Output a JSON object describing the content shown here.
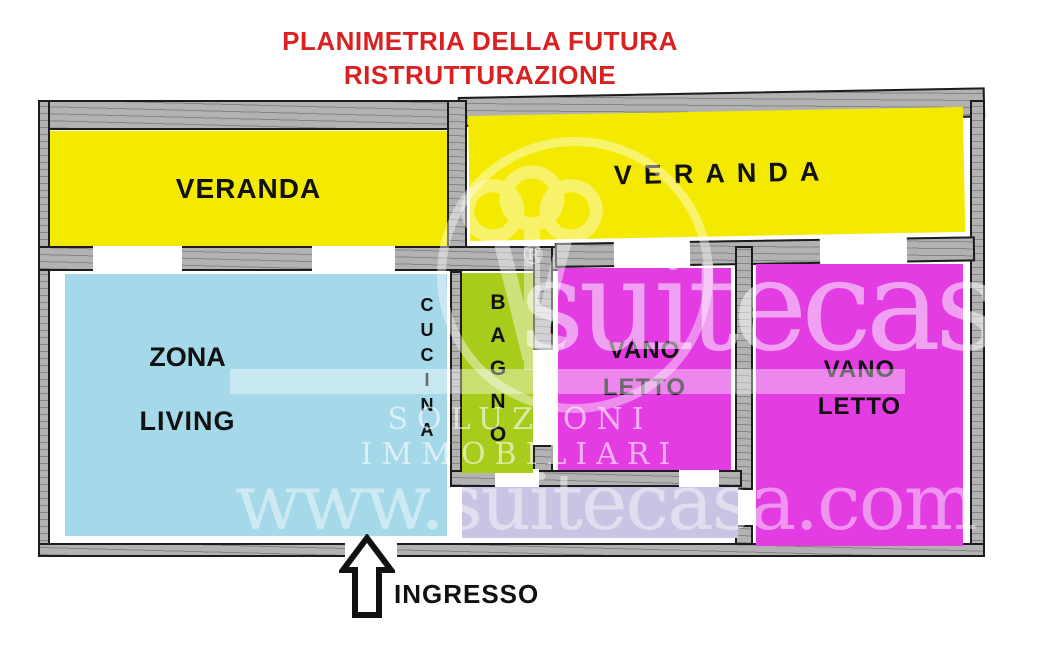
{
  "title": {
    "line1": "PLANIMETRIA DELLA FUTURA",
    "line2": "RISTRUTTURAZIONE"
  },
  "rooms": {
    "veranda_left": {
      "label": "VERANDA"
    },
    "veranda_right": {
      "label": "VERANDA"
    },
    "living": {
      "label_line1": "ZONA",
      "label_line2": "LIVING"
    },
    "kitchen": {
      "label": "CUCINA"
    },
    "bathroom": {
      "label": "BAGNO"
    },
    "bedroom_1": {
      "label_line1": "VANO",
      "label_line2": "LETTO"
    },
    "bedroom_2": {
      "label_line1": "VANO",
      "label_line2": "LETTO"
    }
  },
  "entrance": {
    "label": "INGRESSO"
  },
  "watermark": {
    "brand": "suitecasa",
    "registered": "®",
    "tagline": "SOLUZIONI IMMOBILIARI",
    "website": "www.suitecasa.com"
  },
  "colors": {
    "title_red": "#d92121",
    "veranda_yellow": "#f4e900",
    "living_blue": "#a5d8e8",
    "bath_green": "#a8cc1c",
    "bedroom_magenta": "#e23ce2",
    "corridor_lavender": "#c9c4e4",
    "wall_gray": "#b2b2b2",
    "label_black": "#111111"
  }
}
